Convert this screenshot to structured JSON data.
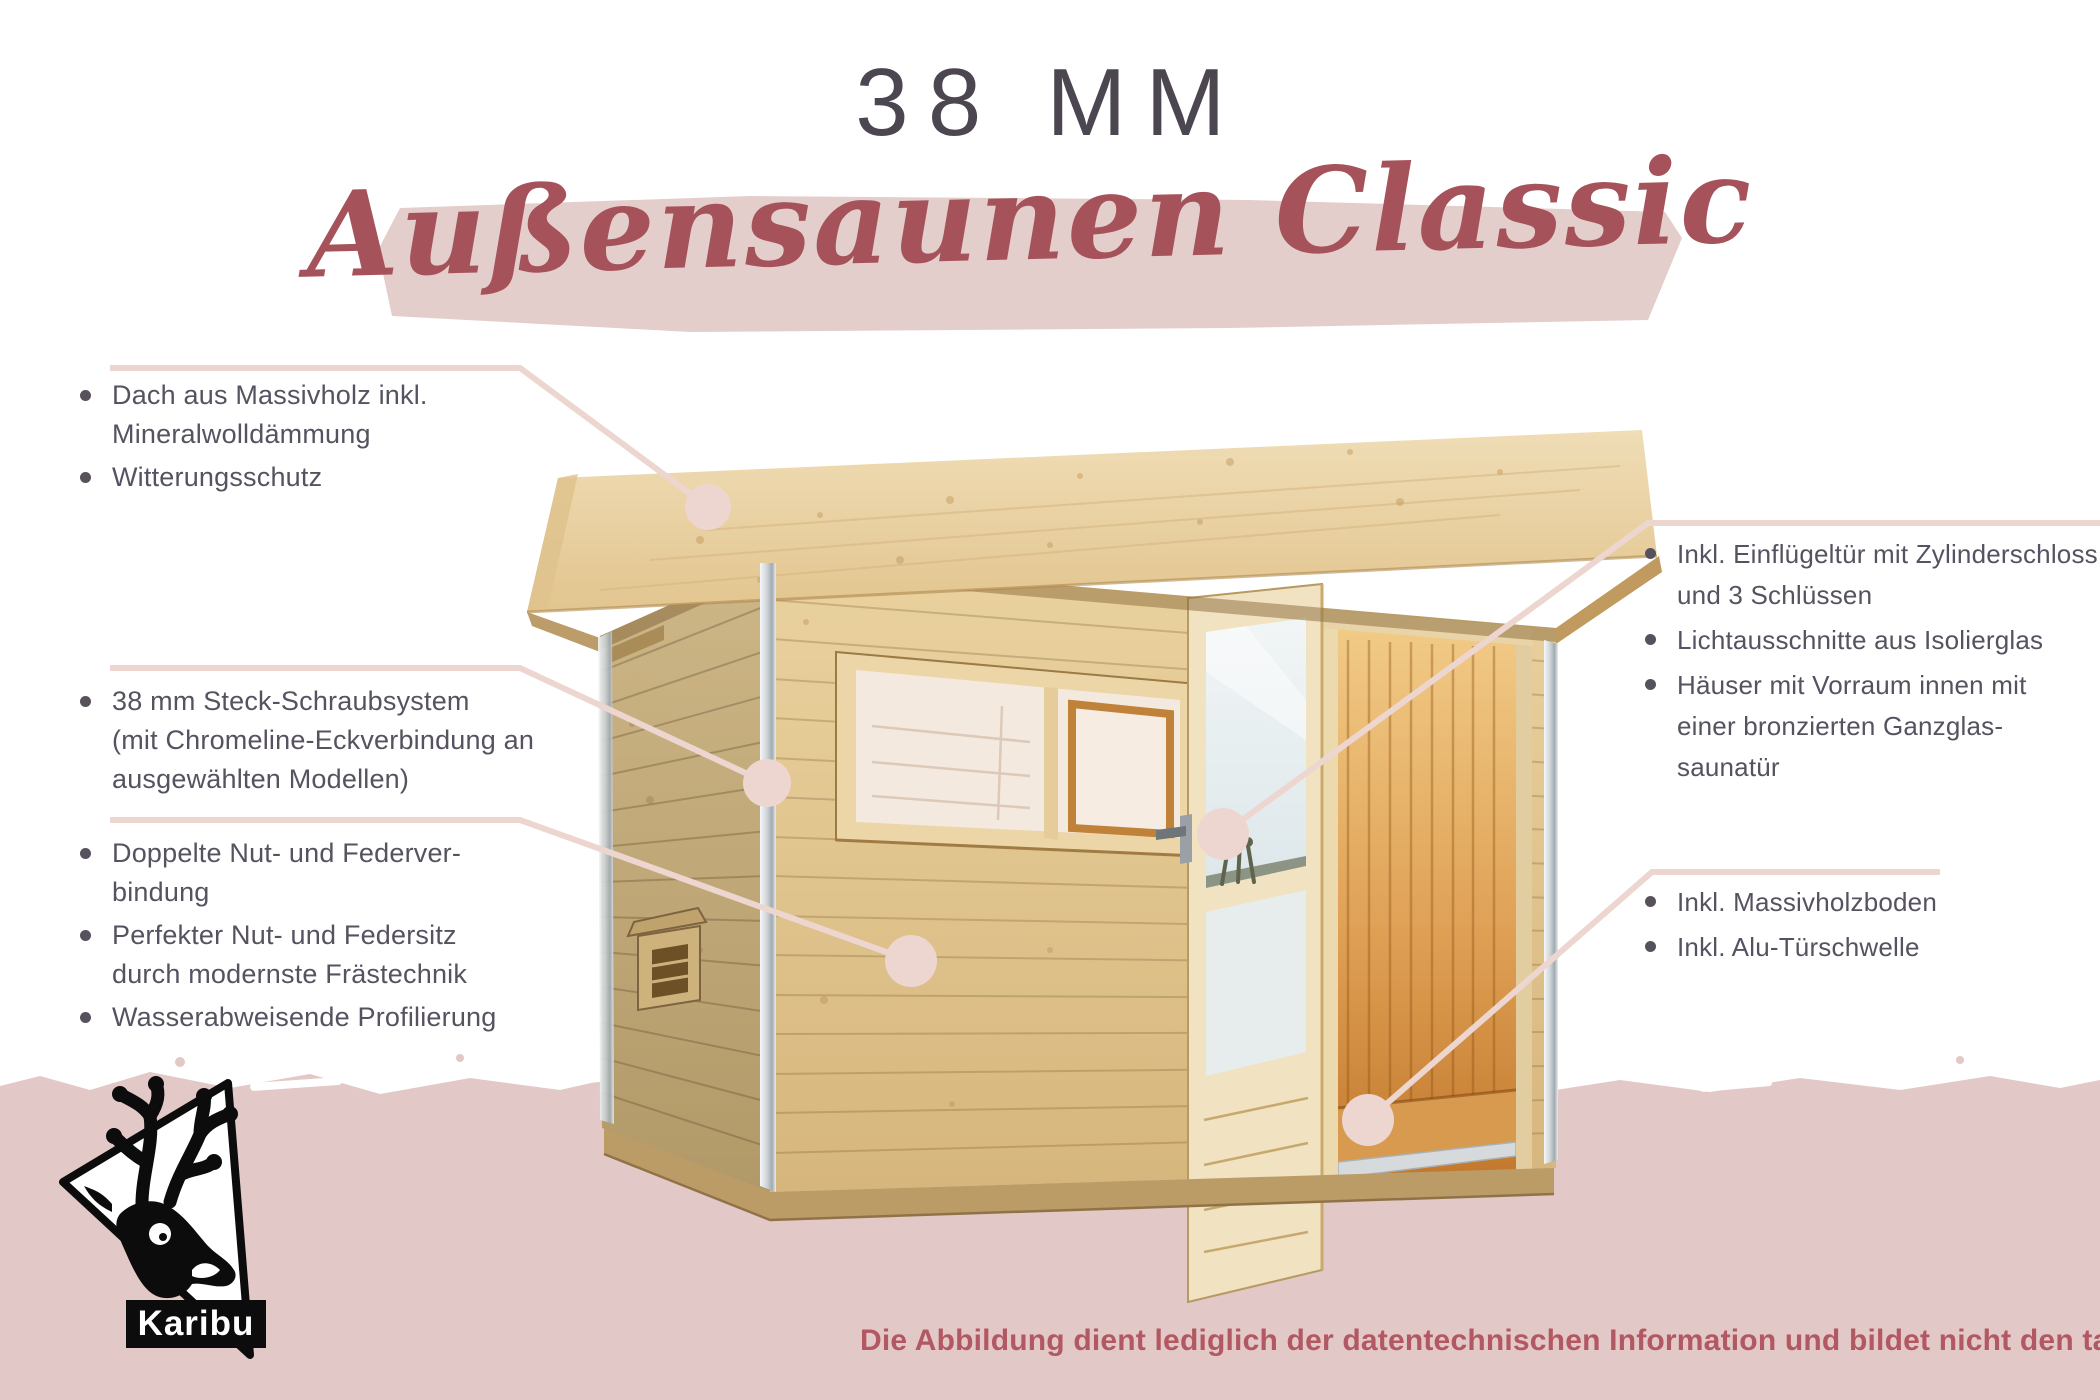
{
  "header": {
    "thickness_label": "38 MM",
    "title": "Außensaunen Classic"
  },
  "feature_groups": {
    "roof": {
      "items": [
        [
          "Dach aus Massivholz inkl.",
          "Mineralwolldämmung"
        ],
        [
          "Witterungsschutz"
        ]
      ]
    },
    "walls": {
      "items": [
        [
          "38 mm Steck-Schraubsystem",
          "(mit Chromeline-Eckverbindung an",
          "ausgewählten Modellen)"
        ]
      ]
    },
    "joinery": {
      "items": [
        [
          "Doppelte Nut- und Federver-",
          "bindung"
        ],
        [
          "Perfekter Nut- und Federsitz",
          "durch modernste Frästechnik"
        ],
        [
          "Wasserabweisende Profilierung"
        ]
      ]
    },
    "door": {
      "items": [
        [
          "Inkl. Einflügeltür mit Zylinderschloss",
          "und 3 Schlüssen"
        ],
        [
          "Lichtausschnitte aus Isolierglas"
        ],
        [
          "Häuser mit Vorraum innen mit",
          "einer bronzierten Ganzglas-",
          "saunatür"
        ]
      ]
    },
    "floor": {
      "items": [
        [
          "Inkl. Massivholzboden"
        ],
        [
          "Inkl. Alu-Türschwelle"
        ]
      ]
    }
  },
  "footer": {
    "logo_text": "Karibu",
    "disclaimer": "Die Abbildung dient lediglich der datentechnischen Information und bildet nicht den tatsächlichen Artikel ab."
  },
  "colors": {
    "accent_rose": "#a5525b",
    "title_gray": "#4b4650",
    "text_gray": "#575260",
    "leader_pink": "#eed6d0",
    "band_pink": "#e2c8c6",
    "brush_pink": "#e4cecb",
    "disclaimer_rose": "#b25862",
    "wood_front": "#e2c28c",
    "wood_side": "#c3ab78",
    "interior_glow": "#cf8733",
    "logo_black": "#0c0c0c"
  }
}
